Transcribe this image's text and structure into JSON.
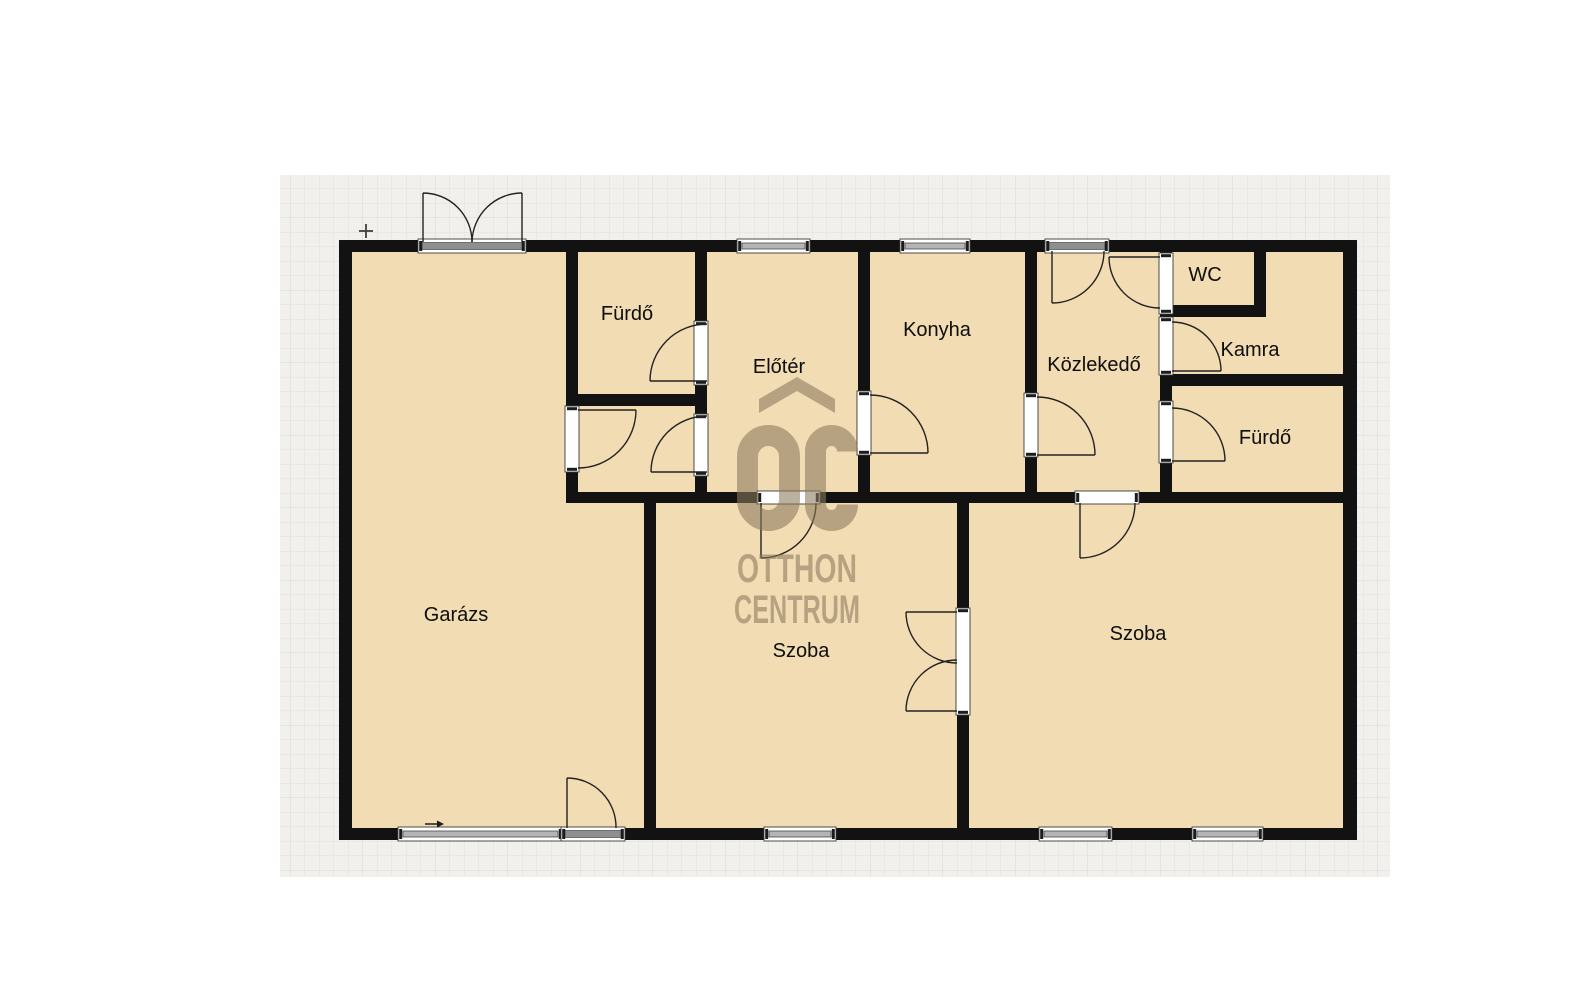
{
  "canvas": {
    "x": 280,
    "y": 175,
    "w": 1110,
    "h": 702,
    "bg": "#f1f0ed",
    "grid_size": 14.5,
    "grid_color": "#e2e1dd",
    "grid_major_color": "#d8d7d2"
  },
  "colors": {
    "floor": "#f2dcb3",
    "wall": "#121212",
    "frame_fill": "#ffffff",
    "frame_stroke": "#3a3a3a",
    "sash_fill": "#b4b4b4",
    "sash_stroke": "#4a4a4a",
    "sill_fill": "#8f8f8f",
    "cap_fill": "#1c1c1c",
    "leaf": "#222222",
    "label": "#0d0d0d",
    "watermark": "#8b7a5c",
    "marker": "#3f3f3f"
  },
  "floor": {
    "x": 352,
    "y": 252,
    "w": 993,
    "h": 576
  },
  "walls": [
    {
      "name": "outer-wall-top",
      "x": 339,
      "y": 240,
      "w": 1018,
      "h": 12
    },
    {
      "name": "outer-wall-bottom",
      "x": 339,
      "y": 828,
      "w": 1018,
      "h": 12
    },
    {
      "name": "outer-wall-left",
      "x": 339,
      "y": 240,
      "w": 13,
      "h": 600
    },
    {
      "name": "outer-wall-right",
      "x": 1343,
      "y": 240,
      "w": 14,
      "h": 600
    },
    {
      "name": "wall-garage-bathcol",
      "x": 566,
      "y": 252,
      "w": 12,
      "h": 240
    },
    {
      "name": "wall-bath1-bottom",
      "x": 578,
      "y": 394,
      "w": 117,
      "h": 12
    },
    {
      "name": "wall-bathcol-eloter",
      "x": 695,
      "y": 252,
      "w": 12,
      "h": 240
    },
    {
      "name": "wall-eloter-konyha",
      "x": 858,
      "y": 252,
      "w": 12,
      "h": 240
    },
    {
      "name": "wall-konyha-kozlekedo",
      "x": 1025,
      "y": 252,
      "w": 12,
      "h": 240
    },
    {
      "name": "wall-kozlekedo-east",
      "x": 1160,
      "y": 252,
      "w": 12,
      "h": 240
    },
    {
      "name": "wall-wc-bottom",
      "x": 1172,
      "y": 305,
      "w": 82,
      "h": 12
    },
    {
      "name": "wall-wc-right",
      "x": 1254,
      "y": 252,
      "w": 12,
      "h": 65
    },
    {
      "name": "wall-kamra-bottom",
      "x": 1172,
      "y": 374,
      "w": 171,
      "h": 12
    },
    {
      "name": "wall-mid-horizontal",
      "x": 566,
      "y": 492,
      "w": 777,
      "h": 11
    },
    {
      "name": "wall-garage-szoba",
      "x": 644,
      "y": 503,
      "w": 12,
      "h": 325
    },
    {
      "name": "wall-szoba-szoba",
      "x": 957,
      "y": 503,
      "w": 12,
      "h": 325
    }
  ],
  "windows": [
    {
      "name": "window-eloter-top",
      "x": 737,
      "y": 239,
      "w": 73,
      "h": 14
    },
    {
      "name": "window-konyha-top",
      "x": 900,
      "y": 239,
      "w": 70,
      "h": 14
    },
    {
      "name": "window-garage-bottom",
      "x": 398,
      "y": 827,
      "w": 165,
      "h": 14
    },
    {
      "name": "window-szoba1-bottom",
      "x": 764,
      "y": 827,
      "w": 72,
      "h": 14
    },
    {
      "name": "window-szoba2-bottom-left",
      "x": 1039,
      "y": 827,
      "w": 73,
      "h": 14
    },
    {
      "name": "window-szoba2-bottom-right",
      "x": 1192,
      "y": 827,
      "w": 71,
      "h": 14
    }
  ],
  "doors": [
    {
      "name": "entry-double-door-garage",
      "sill": true,
      "frame": {
        "x": 418,
        "y": 239,
        "w": 108,
        "h": 14
      },
      "leaves": [
        [
          423,
          242,
          423,
          193
        ],
        [
          522,
          242,
          522,
          193
        ]
      ],
      "arcs": [
        "M472,242 A49,49 0 0 0 423,193",
        "M472,242 A50,50 0 0 1 522,193"
      ]
    },
    {
      "name": "exterior-door-garage-bottom",
      "sill": true,
      "frame": {
        "x": 561,
        "y": 827,
        "w": 64,
        "h": 14
      },
      "leaves": [
        [
          567,
          828,
          567,
          778
        ]
      ],
      "arcs": [
        "M567,778 A49,49 0 0 1 616,828"
      ]
    },
    {
      "name": "door-garage-to-hall",
      "frame": {
        "x": 565,
        "y": 406,
        "w": 14,
        "h": 66
      },
      "leaves": [
        [
          578,
          410,
          636,
          410
        ]
      ],
      "arcs": [
        "M636,410 A58,58 0 0 1 578,468"
      ]
    },
    {
      "name": "door-bath1",
      "frame": {
        "x": 694,
        "y": 321,
        "w": 14,
        "h": 64
      },
      "leaves": [
        [
          707,
          381,
          650,
          381
        ]
      ],
      "arcs": [
        "M650,381 A57,57 0 0 1 707,324"
      ]
    },
    {
      "name": "door-hall-eloter",
      "frame": {
        "x": 694,
        "y": 414,
        "w": 14,
        "h": 62
      },
      "leaves": [
        [
          707,
          472,
          651,
          472
        ]
      ],
      "arcs": [
        "M651,472 A56,56 0 0 1 707,416"
      ]
    },
    {
      "name": "door-konyha",
      "frame": {
        "x": 857,
        "y": 391,
        "w": 14,
        "h": 64
      },
      "leaves": [
        [
          870,
          453,
          928,
          453
        ]
      ],
      "arcs": [
        "M870,395 A58,58 0 0 1 928,453"
      ]
    },
    {
      "name": "door-konyha-kozlekedo",
      "frame": {
        "x": 1024,
        "y": 393,
        "w": 14,
        "h": 64
      },
      "leaves": [
        [
          1037,
          455,
          1095,
          455
        ]
      ],
      "arcs": [
        "M1037,397 A58,58 0 0 1 1095,455"
      ]
    },
    {
      "name": "entry-door-kozlekedo",
      "sill": true,
      "frame": {
        "x": 1045,
        "y": 239,
        "w": 64,
        "h": 14
      },
      "leaves": [
        [
          1052,
          251,
          1052,
          303
        ]
      ],
      "arcs": [
        "M1104,251 A52,52 0 0 1 1052,303"
      ]
    },
    {
      "name": "door-wc",
      "frame": {
        "x": 1159,
        "y": 253,
        "w": 14,
        "h": 61
      },
      "leaves": [
        [
          1160,
          257,
          1109,
          257
        ]
      ],
      "arcs": [
        "M1109,257 A51,51 0 0 0 1160,308"
      ]
    },
    {
      "name": "door-kamra",
      "frame": {
        "x": 1159,
        "y": 317,
        "w": 14,
        "h": 58
      },
      "leaves": [
        [
          1172,
          371,
          1221,
          371
        ]
      ],
      "arcs": [
        "M1172,322 A49,49 0 0 1 1221,371"
      ]
    },
    {
      "name": "door-bath2",
      "frame": {
        "x": 1159,
        "y": 401,
        "w": 14,
        "h": 62
      },
      "leaves": [
        [
          1172,
          461,
          1225,
          461
        ]
      ],
      "arcs": [
        "M1172,408 A53,53 0 0 1 1225,461"
      ]
    },
    {
      "name": "door-eloter-szoba1",
      "frame": {
        "x": 757,
        "y": 491,
        "w": 63,
        "h": 13
      },
      "leaves": [
        [
          761,
          503,
          761,
          558
        ]
      ],
      "arcs": [
        "M816,503 A55,55 0 0 1 761,558"
      ]
    },
    {
      "name": "door-kozlekedo-szoba2",
      "frame": {
        "x": 1075,
        "y": 491,
        "w": 64,
        "h": 13
      },
      "leaves": [
        [
          1080,
          503,
          1080,
          558
        ]
      ],
      "arcs": [
        "M1135,503 A55,55 0 0 1 1080,558"
      ]
    },
    {
      "name": "double-door-szoba-szoba",
      "frame": {
        "x": 956,
        "y": 608,
        "w": 14,
        "h": 107
      },
      "leaves": [
        [
          957,
          612,
          906,
          612
        ],
        [
          957,
          711,
          906,
          711
        ]
      ],
      "arcs": [
        "M957,663 A51,51 0 0 1 906,612",
        "M957,660 A51,51 0 0 0 906,711"
      ]
    }
  ],
  "rooms": [
    {
      "name": "room-furdo-1",
      "label": "Fürdő",
      "x": 627,
      "y": 320
    },
    {
      "name": "room-eloter",
      "label": "Előtér",
      "x": 779,
      "y": 373
    },
    {
      "name": "room-konyha",
      "label": "Konyha",
      "x": 937,
      "y": 336
    },
    {
      "name": "room-kozlekedo",
      "label": "Közlekedő",
      "x": 1094,
      "y": 371
    },
    {
      "name": "room-wc",
      "label": "WC",
      "x": 1205,
      "y": 281
    },
    {
      "name": "room-kamra",
      "label": "Kamra",
      "x": 1250,
      "y": 356
    },
    {
      "name": "room-furdo-2",
      "label": "Fürdő",
      "x": 1265,
      "y": 444
    },
    {
      "name": "room-garazs",
      "label": "Garázs",
      "x": 456,
      "y": 621
    },
    {
      "name": "room-szoba-1",
      "label": "Szoba",
      "x": 801,
      "y": 657
    },
    {
      "name": "room-szoba-2",
      "label": "Szoba",
      "x": 1138,
      "y": 640
    }
  ],
  "label_font_size": 20,
  "watermark": {
    "opacity": 0.58,
    "chevron_path": "M759,399 L797,377 L835,399 L835,413 L797,391 L759,413 Z",
    "o_ring": {
      "x": 747.5,
      "y": 435.5,
      "w": 42,
      "h": 85,
      "rx": 21,
      "stroke_width": 21
    },
    "c_path": "M847.5,451.5 A16,16 0 0 0 815.5,451.5 L815.5,504.5 A16,16 0 0 0 847.5,504.5",
    "c_stroke_width": 21,
    "lines": [
      {
        "name": "watermark-otthon",
        "text": "OTTHON",
        "x": 737,
        "y": 582,
        "length": 120
      },
      {
        "name": "watermark-centrum",
        "text": "CENTRUM",
        "x": 734,
        "y": 623,
        "length": 126
      }
    ],
    "font_size": 40
  },
  "markers": {
    "plus": {
      "x": 366,
      "y": 231,
      "r": 7
    },
    "arrow": {
      "x1": 425,
      "y1": 824,
      "x2": 438,
      "y2": 824
    }
  }
}
